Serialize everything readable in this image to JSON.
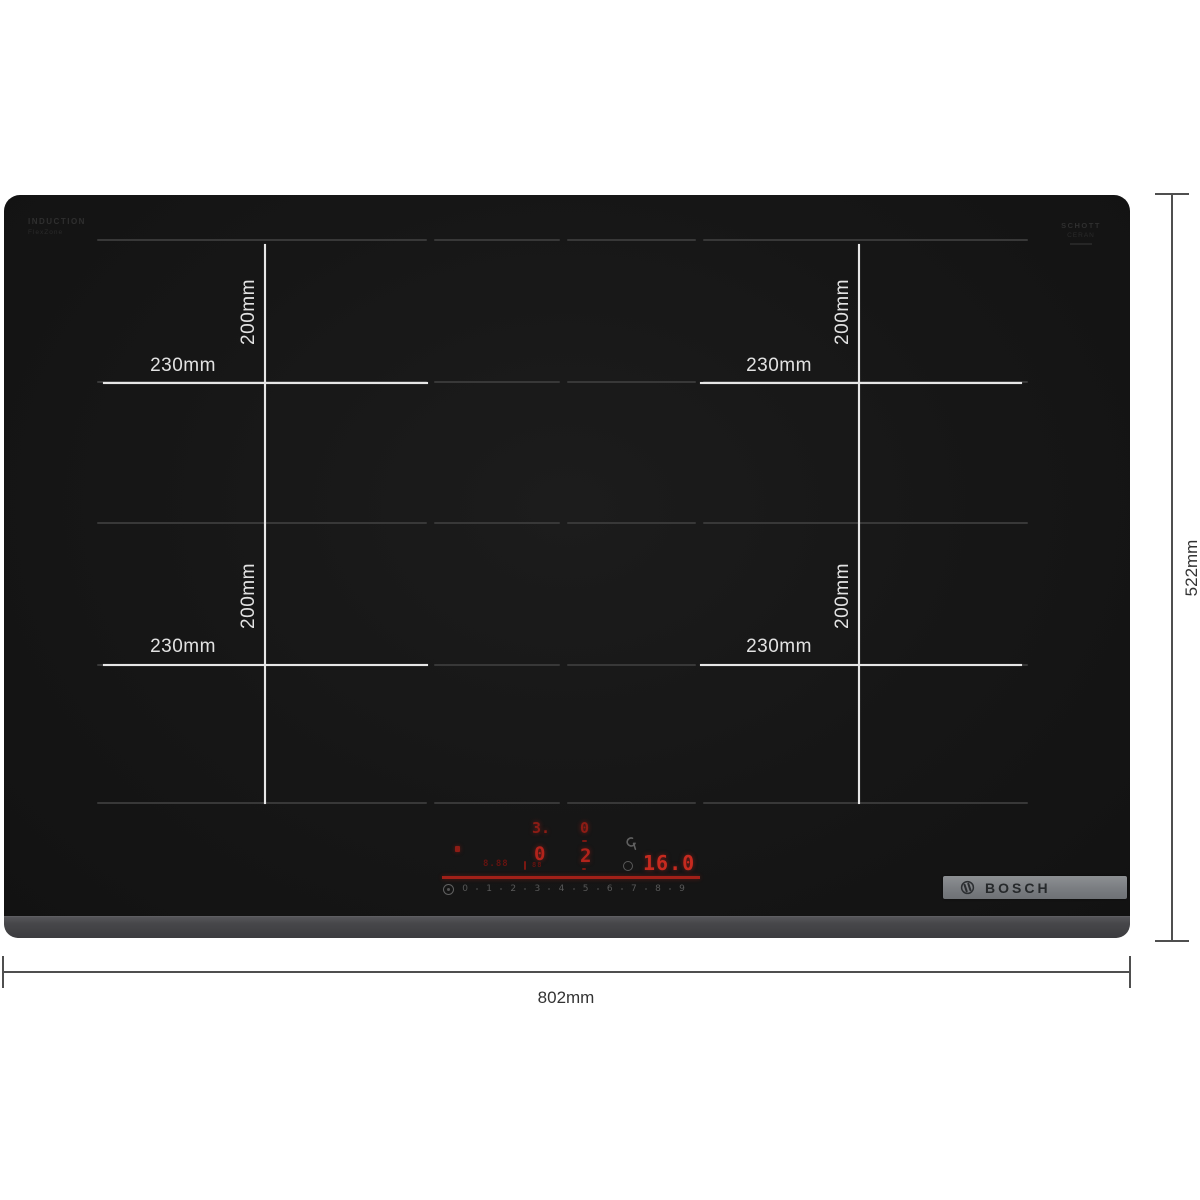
{
  "hob": {
    "glass_color": "#161616",
    "bezel_color": "#47474a",
    "prints": {
      "top_left": {
        "line1": "INDUCTION",
        "line2": "FlexZone"
      },
      "top_right": {
        "line1": "SCHOTT",
        "line2": "CERAN"
      }
    },
    "zones": [
      {
        "id": "top-left",
        "width_label": "230mm",
        "height_label": "200mm"
      },
      {
        "id": "top-right",
        "width_label": "230mm",
        "height_label": "200mm"
      },
      {
        "id": "bottom-left",
        "width_label": "230mm",
        "height_label": "200mm"
      },
      {
        "id": "bottom-right",
        "width_label": "230mm",
        "height_label": "200mm"
      }
    ],
    "control_panel": {
      "accent_red": "#b2231b",
      "zone_displays": {
        "top_left": "3.",
        "top_right": "0",
        "bottom_left": "0",
        "bottom_right": "2"
      },
      "aux_left": "8.88",
      "aux_right": "88",
      "timer_display": "16.0",
      "slider_scale": [
        "0",
        "1",
        "2",
        "3",
        "4",
        "5",
        "6",
        "7",
        "8",
        "9"
      ],
      "icons": {
        "power_indicator": "red-dot",
        "service_wrench": "wrench",
        "timer_ring": "ring",
        "slider_start": "circled-dot"
      }
    },
    "badge": {
      "brand": "BOSCH",
      "bg": "#7a7d81",
      "text_color": "#26292b"
    }
  },
  "dimensions": {
    "overall_width_label": "802mm",
    "overall_height_label": "522mm",
    "line_color": "#4f4f4f",
    "text_color": "#333333",
    "zone_line_color": "#e6e6e6"
  }
}
